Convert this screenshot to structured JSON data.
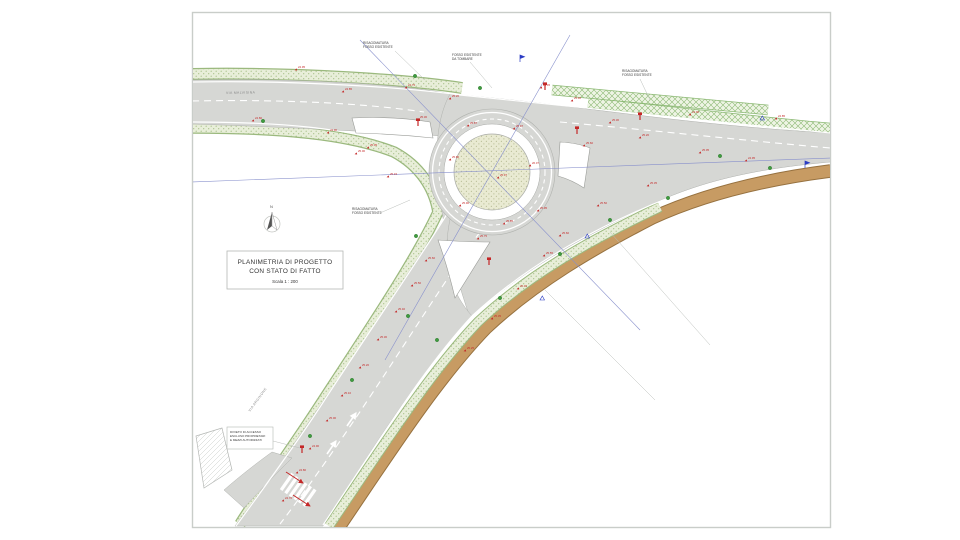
{
  "title_block": {
    "line1": "PLANIMETRIA DI PROGETTO",
    "line2": "CON STATO DI FATTO",
    "scale": "Scala 1 : 200"
  },
  "north": {
    "label": "N"
  },
  "road_labels": [
    {
      "text": "VIA MALVISINA"
    },
    {
      "text": "VIA ARGINONE"
    }
  ],
  "annotations": [
    {
      "lines": [
        "RISAGOMATURA",
        "FOSSO ESISTENTE"
      ]
    },
    {
      "lines": [
        "FOSSO ESISTENTE",
        "DA TOMBARE"
      ]
    },
    {
      "lines": [
        "RISAGOMATURA",
        "FOSSO ESISTENTE"
      ]
    },
    {
      "lines": [
        "RISAGOMATURA",
        "FOSSO ESISTENTE"
      ]
    }
  ],
  "note_box": {
    "lines": [
      "DIVIETO DI ACCESSO",
      "ESCLUSO PROPRIETARI",
      "E MEZZI AUTORIZZATI"
    ]
  },
  "colors": {
    "red": "#c42727",
    "blue": "#2b3cc4",
    "tree": "#3f9b3f",
    "tree_ring": "#2e7b2e",
    "road": "#d6d7d4",
    "brown": "#c79b63",
    "brown_edge": "#96713f",
    "verge_green": "#9bb97e"
  },
  "elevations": [
    [
      298,
      68,
      "24.95"
    ],
    [
      345,
      90,
      "24.85"
    ],
    [
      408,
      86,
      "24.75"
    ],
    [
      330,
      131,
      "24.90"
    ],
    [
      370,
      146,
      "25.05"
    ],
    [
      255,
      119,
      "24.80"
    ],
    [
      452,
      97,
      "25.20"
    ],
    [
      420,
      118,
      "25.30"
    ],
    [
      543,
      86,
      "25.45"
    ],
    [
      574,
      99,
      "25.40"
    ],
    [
      612,
      121,
      "25.30"
    ],
    [
      642,
      136,
      "25.20"
    ],
    [
      702,
      151,
      "25.05"
    ],
    [
      748,
      159,
      "24.95"
    ],
    [
      778,
      117,
      "24.85"
    ],
    [
      692,
      113,
      "24.90"
    ],
    [
      470,
      124,
      "25.87"
    ],
    [
      516,
      127,
      "25.97"
    ],
    [
      452,
      158,
      "25.80"
    ],
    [
      500,
      176,
      "25.97"
    ],
    [
      532,
      164,
      "26.07"
    ],
    [
      462,
      204,
      "25.90"
    ],
    [
      506,
      222,
      "25.85"
    ],
    [
      540,
      209,
      "25.95"
    ],
    [
      480,
      237,
      "25.75"
    ],
    [
      428,
      259,
      "25.60"
    ],
    [
      414,
      284,
      "25.50"
    ],
    [
      398,
      310,
      "25.40"
    ],
    [
      380,
      338,
      "25.30"
    ],
    [
      362,
      366,
      "25.20"
    ],
    [
      344,
      394,
      "25.10"
    ],
    [
      329,
      419,
      "25.00"
    ],
    [
      312,
      447,
      "24.90"
    ],
    [
      299,
      471,
      "24.80"
    ],
    [
      285,
      499,
      "24.70"
    ],
    [
      546,
      254,
      "25.55"
    ],
    [
      520,
      287,
      "25.45"
    ],
    [
      494,
      317,
      "25.35"
    ],
    [
      467,
      349,
      "25.25"
    ],
    [
      562,
      234,
      "25.60"
    ],
    [
      600,
      204,
      "25.50"
    ],
    [
      650,
      184,
      "25.35"
    ],
    [
      586,
      144,
      "25.60"
    ],
    [
      358,
      152,
      "25.00"
    ],
    [
      390,
      175,
      "25.15"
    ]
  ],
  "trees": [
    [
      263,
      121
    ],
    [
      415,
      76
    ],
    [
      480,
      88
    ],
    [
      720,
      156
    ],
    [
      770,
      168
    ],
    [
      416,
      236
    ],
    [
      437,
      340
    ],
    [
      408,
      316
    ],
    [
      352,
      380
    ],
    [
      500,
      298
    ],
    [
      560,
      254
    ],
    [
      610,
      220
    ],
    [
      668,
      198
    ],
    [
      310,
      436
    ]
  ],
  "flags": [
    [
      520,
      62
    ],
    [
      805,
      168
    ]
  ],
  "blue_triangles": [
    [
      585,
      238
    ],
    [
      540,
      300
    ],
    [
      760,
      120
    ]
  ],
  "signs": [
    [
      418,
      126
    ],
    [
      545,
      90
    ],
    [
      577,
      134
    ],
    [
      302,
      453
    ],
    [
      489,
      265
    ],
    [
      640,
      120
    ]
  ]
}
